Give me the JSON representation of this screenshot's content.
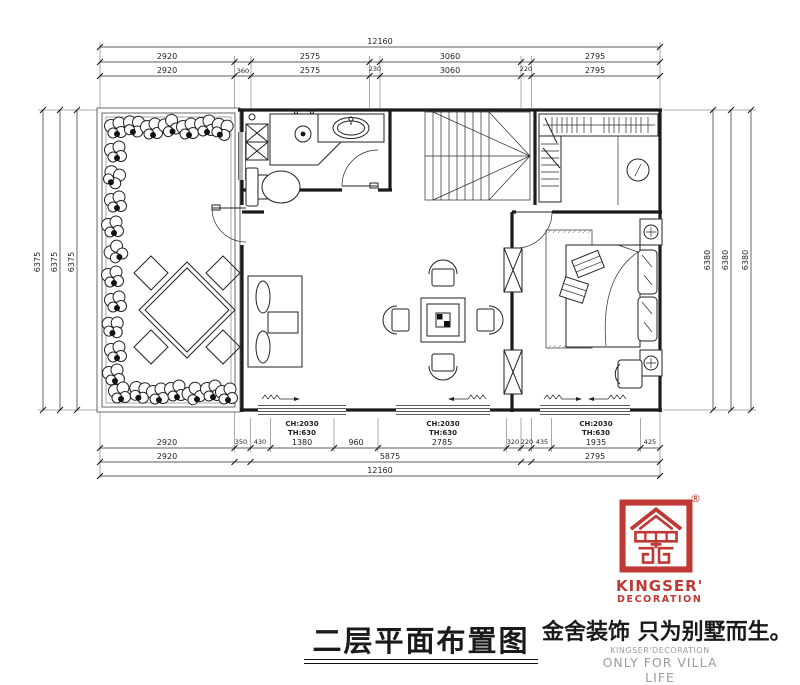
{
  "plan": {
    "title": "二层平面布置图",
    "window_labels": [
      {
        "line1": "CH:2030",
        "line2": "TH:630"
      },
      {
        "line1": "CH:2030",
        "line2": "TH:630"
      },
      {
        "line1": "CH:2030",
        "line2": "TH:630"
      }
    ],
    "dimensions": {
      "top_total": "12160",
      "top_mid": [
        "2920",
        "2575",
        "3060",
        "2795"
      ],
      "top_inner": [
        "2920",
        "360",
        "2575",
        "230",
        "3060",
        "220",
        "2795"
      ],
      "bottom_inner": [
        "2920",
        "350",
        "430",
        "1380",
        "960",
        "2785",
        "320",
        "220",
        "435",
        "1935",
        "425"
      ],
      "bottom_mid": [
        "2920",
        "5875",
        "2795"
      ],
      "bottom_total": "12160",
      "left": [
        "6375",
        "6375",
        "6375"
      ],
      "right": [
        "6380",
        "6380",
        "6380"
      ]
    }
  },
  "branding": {
    "logo_line1": "KINGSER'",
    "logo_line2": "DECORATION",
    "registered": "®",
    "slogan_cn": "金舍装饰 只为别墅而生。",
    "slogan_en1": "KINGSER'DECORATION",
    "slogan_en2": "ONLY FOR VILLA LIFE",
    "brand_red": "#bf3a34",
    "slogan_gray": "#9b9b9b",
    "line_color": "#1c1c1c"
  }
}
